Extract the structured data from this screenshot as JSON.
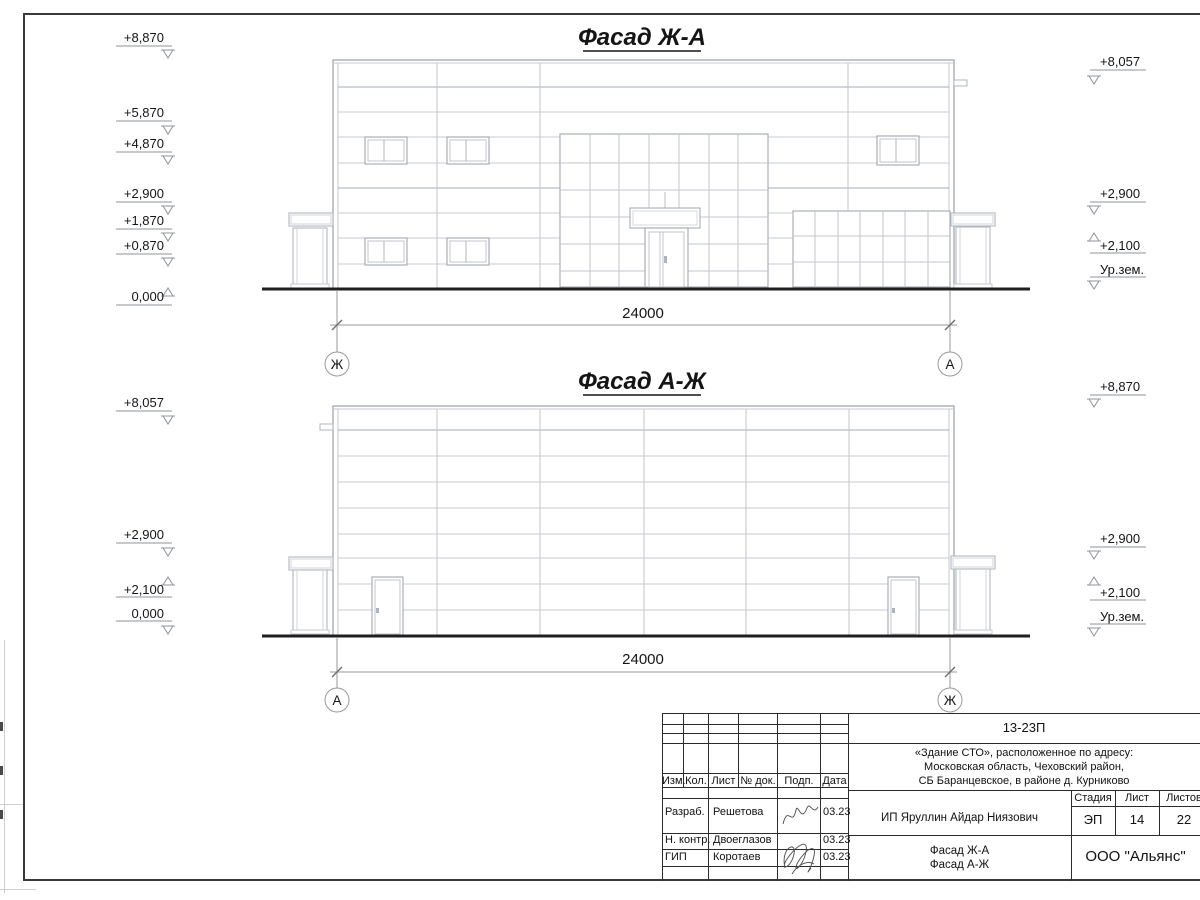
{
  "drawing": {
    "facade1": {
      "title": "Фасад Ж-А",
      "dimension_label": "24000",
      "axis_left": "Ж",
      "axis_right": "А",
      "marks_left": [
        "+8,870",
        "+5,870",
        "+4,870",
        "+2,900",
        "+1,870",
        "+0,870",
        "0,000"
      ],
      "marks_right": [
        "+8,057",
        "+2,900",
        "+2,100",
        "Ур.зем."
      ]
    },
    "facade2": {
      "title": "Фасад А-Ж",
      "dimension_label": "24000",
      "axis_left": "А",
      "axis_right": "Ж",
      "marks_left": [
        "+8,057",
        "+2,900",
        "+2,100",
        "0,000"
      ],
      "marks_right": [
        "+8,870",
        "+2,900",
        "+2,100",
        "Ур.зем."
      ]
    }
  },
  "title_block": {
    "doc_number": "13-23П",
    "address_line1": "«Здание СТО», расположенное по адресу:",
    "address_line2": "Московская область, Чеховский район,",
    "address_line3": "СБ Баранцевское, в районе д. Курниково",
    "cols": {
      "izm": "Изм.",
      "kol": "Кол.",
      "list": "Лист",
      "ndok": "№ док.",
      "podp": "Подп.",
      "data": "Дата"
    },
    "row_razrab": {
      "role": "Разраб.",
      "name": "Решетова",
      "date": "03.23"
    },
    "row_nkontr": {
      "role": "Н. контр.",
      "name": "Двоеглазов",
      "date": "03.23"
    },
    "row_gip": {
      "role": "ГИП",
      "name": "Коротаев",
      "date": "03.23"
    },
    "client": "ИП Яруллин Айдар Ниязович",
    "stage_label": "Стадия",
    "sheet_label": "Лист",
    "sheets_label": "Листов",
    "stage": "ЭП",
    "sheet": "14",
    "sheets": "22",
    "sheet_title_line1": "Фасад Ж-А",
    "sheet_title_line2": "Фасад А-Ж",
    "company": "ООО \"Альянс\""
  }
}
